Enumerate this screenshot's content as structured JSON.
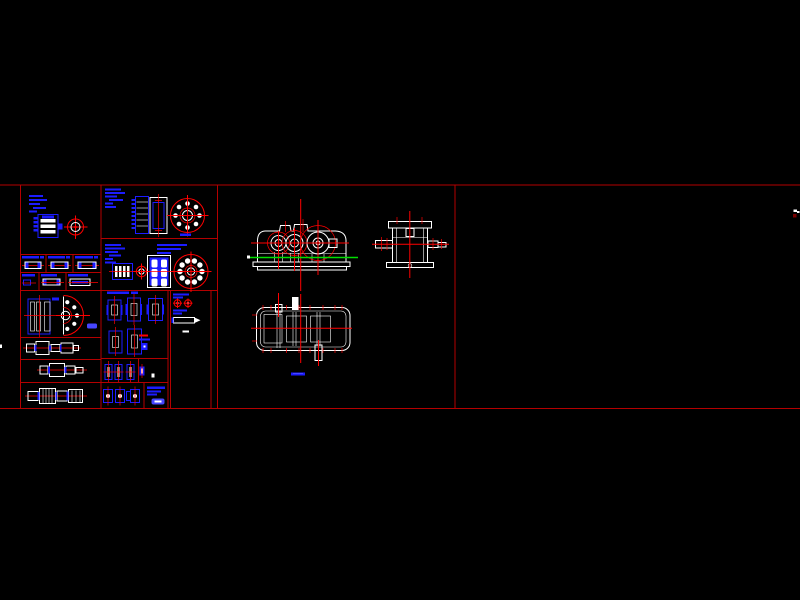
{
  "canvas": {
    "width": 800,
    "height": 600,
    "type": "cad-layout-drawing",
    "description_of_pixels": "black AutoCAD-style workspace; horizontal band of red drawing frames containing blue part detail drawings on the left, white gearbox assembly views (front, side, top) in the middle frame, and an empty frame on the right",
    "visible_text": []
  },
  "colors": {
    "background": "#000000",
    "frame": "#b40000",
    "centerline": "#ff0000",
    "geometry_white": "#ffffff",
    "part_blue": "#1c1cff",
    "part_blue_bright": "#4646ff",
    "highlight_green": "#00dd00",
    "dark_red": "#7a0000"
  },
  "layout": {
    "drawing_band": {
      "top": 184,
      "bottom": 409
    },
    "panels": [
      {
        "name": "parts-sheet",
        "x": 20,
        "x2": 217,
        "cells": [
          "motor-unit",
          "flat-key-1",
          "flat-key-2",
          "flat-key-3",
          "key-4",
          "key-5",
          "key-6",
          "gear-flange-section",
          "shaft-1",
          "shaft-2",
          "shaft-3",
          "gear-shaft-and-wheel",
          "coupling-bearing-wheel",
          "bearing-caps",
          "pin-fasteners",
          "small-fasteners",
          "washer-cell",
          "accessory-column"
        ]
      },
      {
        "name": "assembly-sheet",
        "x": 218,
        "x2": 455,
        "views": [
          "front-view",
          "side-view",
          "top-view"
        ],
        "extras": [
          "green-datum-line",
          "blue-dash-marker"
        ]
      },
      {
        "name": "empty-panel",
        "x": 455,
        "x2": 800,
        "extras": [
          "edge-cursor-mark"
        ]
      }
    ]
  }
}
